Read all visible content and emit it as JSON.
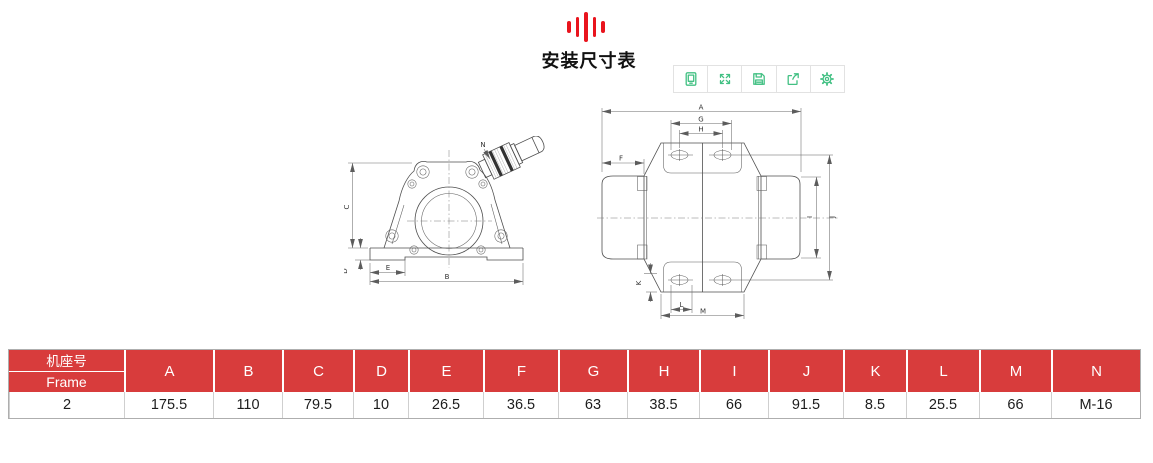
{
  "page": {
    "title": "安装尺寸表"
  },
  "logo": {
    "name": "vibration-bars-logo",
    "color": "#e9141d"
  },
  "toolbar": {
    "icon_color": "#42c083",
    "icons": [
      "screen-icon",
      "expand-icon",
      "save-icon",
      "share-icon",
      "settings-icon"
    ]
  },
  "drawings": {
    "front_view": {
      "name": "motor-front-view",
      "labels": {
        "N": "N",
        "C": "C",
        "D": "D",
        "E": "E",
        "B": "B"
      }
    },
    "top_view": {
      "name": "motor-top-view",
      "labels": {
        "A": "A",
        "G": "G",
        "H": "H",
        "F": "F",
        "I": "I",
        "J": "J",
        "K": "K",
        "L": "L",
        "M": "M"
      }
    }
  },
  "table": {
    "header_bg": "#d83c3c",
    "frame_header": {
      "zh": "机座号",
      "en": "Frame"
    },
    "columns": [
      "A",
      "B",
      "C",
      "D",
      "E",
      "F",
      "G",
      "H",
      "I",
      "J",
      "K",
      "L",
      "M",
      "N"
    ],
    "row": [
      "2",
      "175.5",
      "110",
      "79.5",
      "10",
      "26.5",
      "36.5",
      "63",
      "38.5",
      "66",
      "91.5",
      "8.5",
      "25.5",
      "66",
      "M-16"
    ]
  }
}
